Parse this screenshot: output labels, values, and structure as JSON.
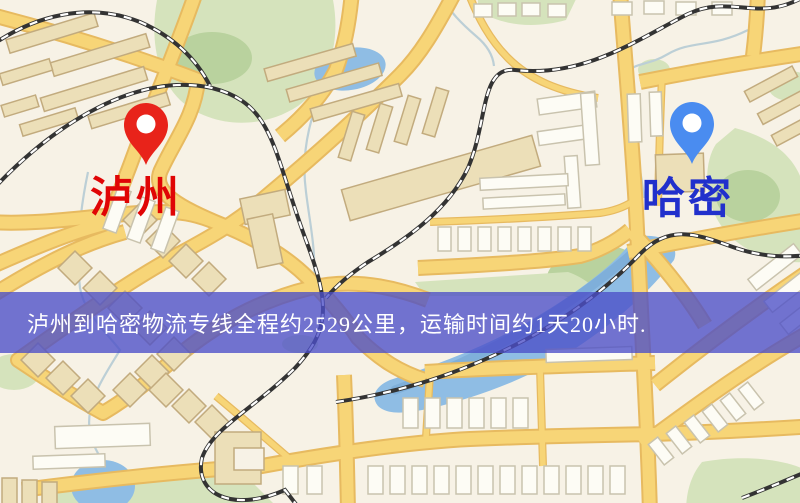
{
  "banner": {
    "text": "泸州到哈密物流专线全程约2529公里，运输时间约1天20小时."
  },
  "markers": {
    "origin": {
      "label": "泸州"
    },
    "destination": {
      "label": "哈密"
    }
  },
  "palette": {
    "map_background": "#f7f2e6",
    "park": "#d5e3bc",
    "park_dark": "#b9d29e",
    "water": "#8fbde4",
    "water_dark": "#7fafda",
    "road": "#f7d577",
    "road_casing": "#e7ba60",
    "building": "#fdfcf5",
    "building_stroke": "#c9c3ae",
    "building_tan": "#ecdfb8",
    "building_tan_stroke": "#c2ab7e",
    "railway": "#333333",
    "stream": "#bccfd6",
    "origin_pin": "#e8231a",
    "dest_pin": "#4a8cf0",
    "origin_label": "#e00505",
    "dest_label": "#2130cc",
    "banner_bg": "rgba(76,78,200,0.78)",
    "banner_text": "#ffffff"
  }
}
